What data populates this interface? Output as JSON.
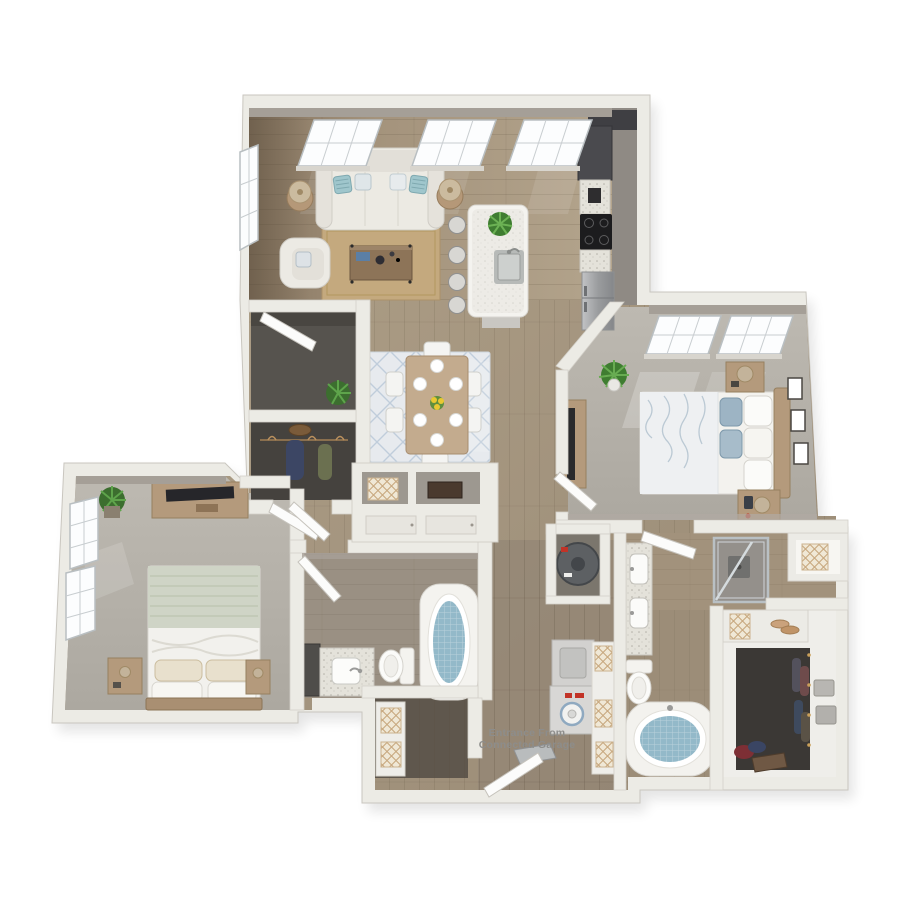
{
  "scene": {
    "title": "3D apartment floor plan rendering",
    "background": "#ffffff",
    "annotation": {
      "line1": "Entrance From",
      "line2": "Connected Garage",
      "color": "#8d8d8b"
    }
  },
  "palette": {
    "wall": "#ecebe5",
    "wall_shadow": "#a59f97",
    "wood_floor_hall": "#a79881",
    "wood_floor_living": "#9c8b74",
    "wood_floor_laundry": "#8e8173",
    "carpet": "#b6b2aa",
    "dark_entry_floor": "#55524d",
    "closet_floor": "#45423e",
    "rug_jute": "#c4a97e",
    "rug_dining": "#e7eaee",
    "cabinet_dark": "#46464a",
    "counter_speckled": "#e4e2da",
    "accent_teal_pillow": "#9fc6cc",
    "tub_water": "#93b9c9",
    "greenery": "#3f7d31",
    "wood_furniture": "#b49a7c",
    "sage_blanket": "#cfd4c6"
  },
  "rooms": [
    {
      "id": "living-room",
      "furniture": [
        "sofa with teal accent pillows",
        "armchair",
        "coffee table with decor",
        "jute area rug",
        "2 floor lamps with side tables",
        "3 transom windows",
        "side window"
      ]
    },
    {
      "id": "kitchen",
      "furniture": [
        "island with sink and faucet",
        "potted plant on island",
        "4 wire bar stools",
        "dark cabinet run",
        "black cooktop",
        "refrigerator",
        "coffee maker"
      ]
    },
    {
      "id": "dining-area",
      "furniture": [
        "wood dining table",
        "6 chairs",
        "6 white place settings",
        "yellow centerpiece flowers",
        "blue patterned area rug"
      ]
    },
    {
      "id": "entry-foyer",
      "furniture": [
        "front entry door",
        "potted plant"
      ]
    },
    {
      "id": "coat-closet",
      "furniture": [
        "hanging rod",
        "navy garment",
        "olive garment",
        "hat on shelf"
      ]
    },
    {
      "id": "hall-built-in",
      "furniture": [
        "open cubby with lattice basket",
        "open cubby with wood box",
        "lower cabinet doors"
      ]
    },
    {
      "id": "master-bedroom",
      "furniture": [
        "bed with blue floral duvet",
        "blue and white pillows",
        "2 wood nightstands",
        "2 table lamps",
        "tv console with tv",
        "3 picture frames",
        "potted plant",
        "2 windows with sun patches"
      ]
    },
    {
      "id": "bedroom-2",
      "furniture": [
        "bed with sage green blanket",
        "patterned pillows",
        "2 nightstands",
        "tv console with tv",
        "potted plant",
        "2 side windows"
      ]
    },
    {
      "id": "bathroom-2",
      "furniture": [
        "vanity with sink",
        "dark storage cabinet",
        "toilet",
        "oval soaking tub",
        "entry door"
      ]
    },
    {
      "id": "master-bathroom",
      "furniture": [
        "double vanity with 2 sinks",
        "glass shower",
        "toilet",
        "oval soaking tub",
        "linen niche with lattice basket",
        "bench with basket and shoes",
        "entry door"
      ]
    },
    {
      "id": "walk-in-closet",
      "furniture": [
        "hanging clothes",
        "white shelving",
        "2 gray storage boxes",
        "suitcase",
        "clothes pile",
        "gold hooks"
      ]
    },
    {
      "id": "laundry-mudroom",
      "furniture": [
        "stacked dryer and washer",
        "shelf column with 3 lattice baskets",
        "water heater in closet",
        "storage niche with 2 lattice baskets",
        "garage entry door",
        "utility bench"
      ]
    }
  ]
}
